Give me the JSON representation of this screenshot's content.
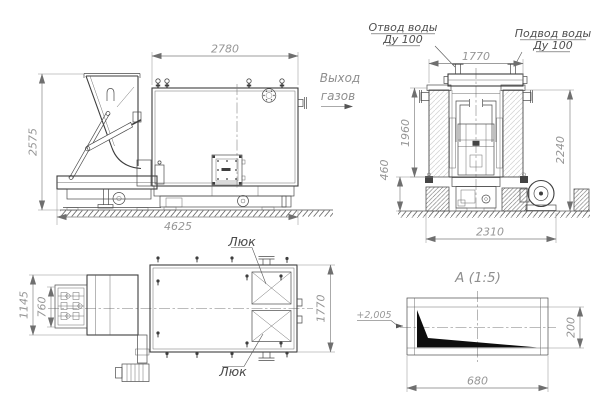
{
  "side_view": {
    "dim_boiler_length": "2780",
    "dim_total_height": "2575",
    "dim_total_length": "4625",
    "gas_outlet_line1": "Выход",
    "gas_outlet_line2": "газов"
  },
  "front_view": {
    "water_outlet_line1": "Отвод воды",
    "water_outlet_line2": "Ду 100",
    "water_inlet_line1": "Подвод воды",
    "water_inlet_line2": "Ду 100",
    "dim_width_top": "1770",
    "dim_body_height": "1960",
    "dim_base_height": "460",
    "dim_total_height": "2240",
    "dim_base_width": "2310"
  },
  "top_view": {
    "hatch_label_top": "Люк",
    "hatch_label_bottom": "Люк",
    "dim_feeder_width": "1145",
    "dim_feeder_inner_width": "760",
    "dim_boiler_width": "1770"
  },
  "detail_view": {
    "title": "А (1:5)",
    "elevation_mark": "+2,005",
    "dim_length": "680",
    "dim_height": "200"
  }
}
